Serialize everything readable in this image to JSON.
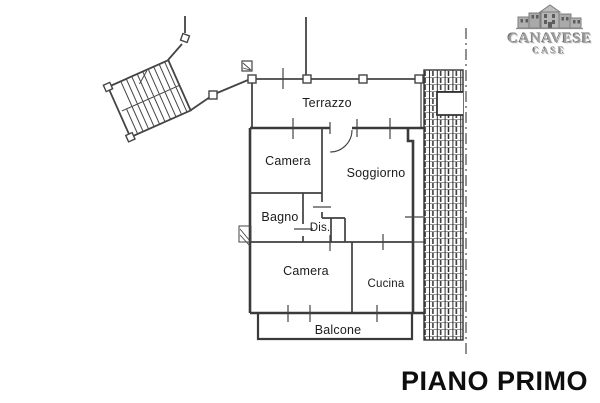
{
  "plan": {
    "title": "PIANO PRIMO",
    "rooms": [
      {
        "name": "terrazzo",
        "label": "Terrazzo"
      },
      {
        "name": "camera-1",
        "label": "Camera"
      },
      {
        "name": "soggiorno",
        "label": "Soggiorno"
      },
      {
        "name": "bagno",
        "label": "Bagno"
      },
      {
        "name": "disimpegno",
        "label": "Dis."
      },
      {
        "name": "camera-2",
        "label": "Camera"
      },
      {
        "name": "cucina",
        "label": "Cucina"
      },
      {
        "name": "balcone",
        "label": "Balcone"
      }
    ],
    "line_color": "#404040",
    "boundary_line_style": "dash-dot",
    "hatch_color": "#2e2e2e"
  },
  "logo": {
    "brand": "CANAVESE",
    "brand_sub": "CASE",
    "color": "#9e9e9e"
  }
}
